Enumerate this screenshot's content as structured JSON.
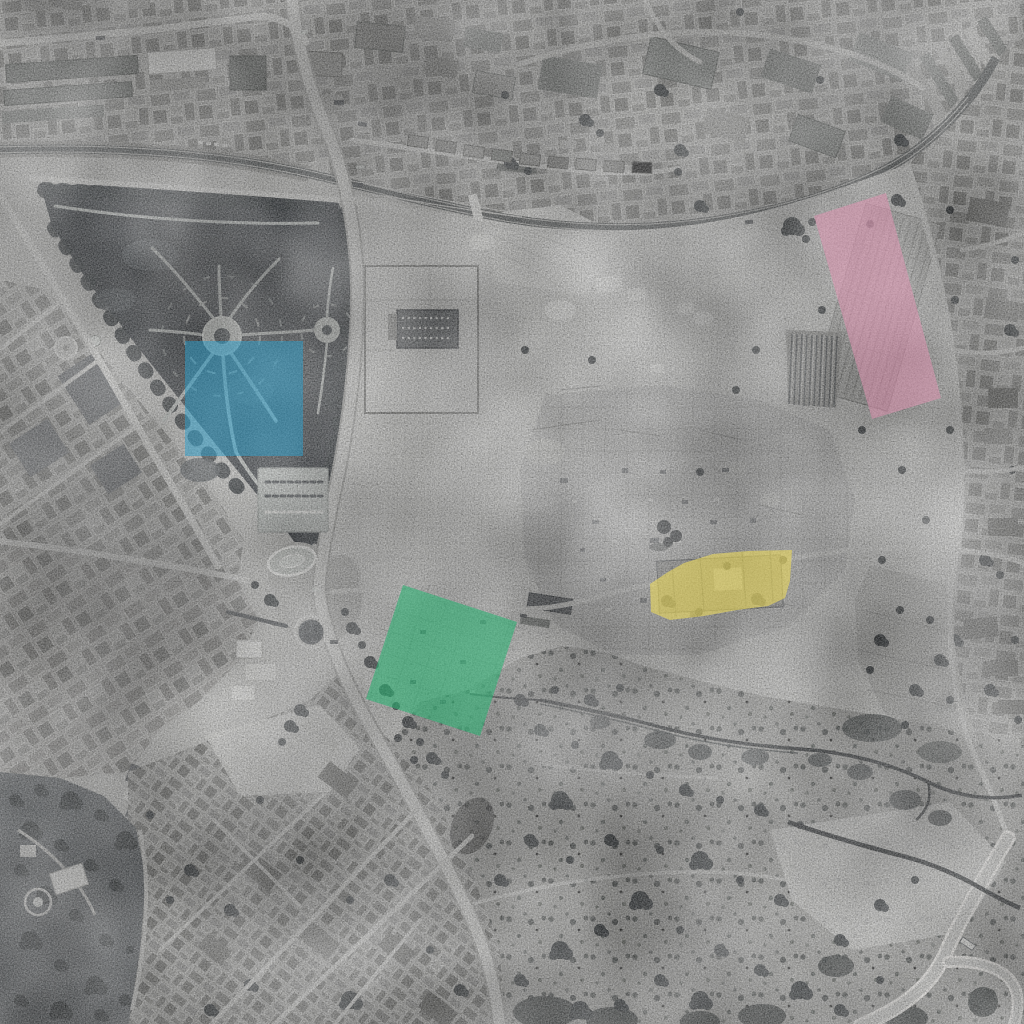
{
  "document": {
    "title": "Black-and-white vertical aerial photograph with four coloured highlight zones",
    "type": "annotated aerial / satellite photograph",
    "canvas": {
      "width": 1024,
      "height": 1024
    }
  },
  "photo": {
    "style": "grayscale aerial survey photograph",
    "features": [
      "dense town blocks along the north edge",
      "railway line curving west-east across the north",
      "triangular tree-filled public garden on the west",
      "oval plaza and multi-road junction below the garden",
      "large pale archaeological ruins field in the centre and east",
      "walled excavation enclosure with colonnaded building",
      "old-town housing in the south-west",
      "scrub-covered slopes with a dark ravine in the south-east",
      "hairpin road curve in the south-east corner"
    ]
  },
  "overlays": {
    "blue": {
      "id": "zone-blue",
      "label": "blue highlighted zone (square over the wooded garden, west-centre)",
      "color": "#2d9ec9",
      "opacity": "0.52"
    },
    "pink": {
      "id": "zone-pink",
      "label": "pink highlighted zone (slanted strip over colonnade ruins, north-east)",
      "color": "#de93b1",
      "opacity": "0.55"
    },
    "yellow": {
      "id": "zone-yellow",
      "label": "yellow highlighted zone (irregular polygon over building complex, centre-east)",
      "color": "#ead95f",
      "opacity": "0.62"
    },
    "green": {
      "id": "zone-green",
      "label": "green highlighted zone (tilted square over grid ruins, centre)",
      "color": "#2fb375",
      "opacity": "0.60"
    }
  }
}
